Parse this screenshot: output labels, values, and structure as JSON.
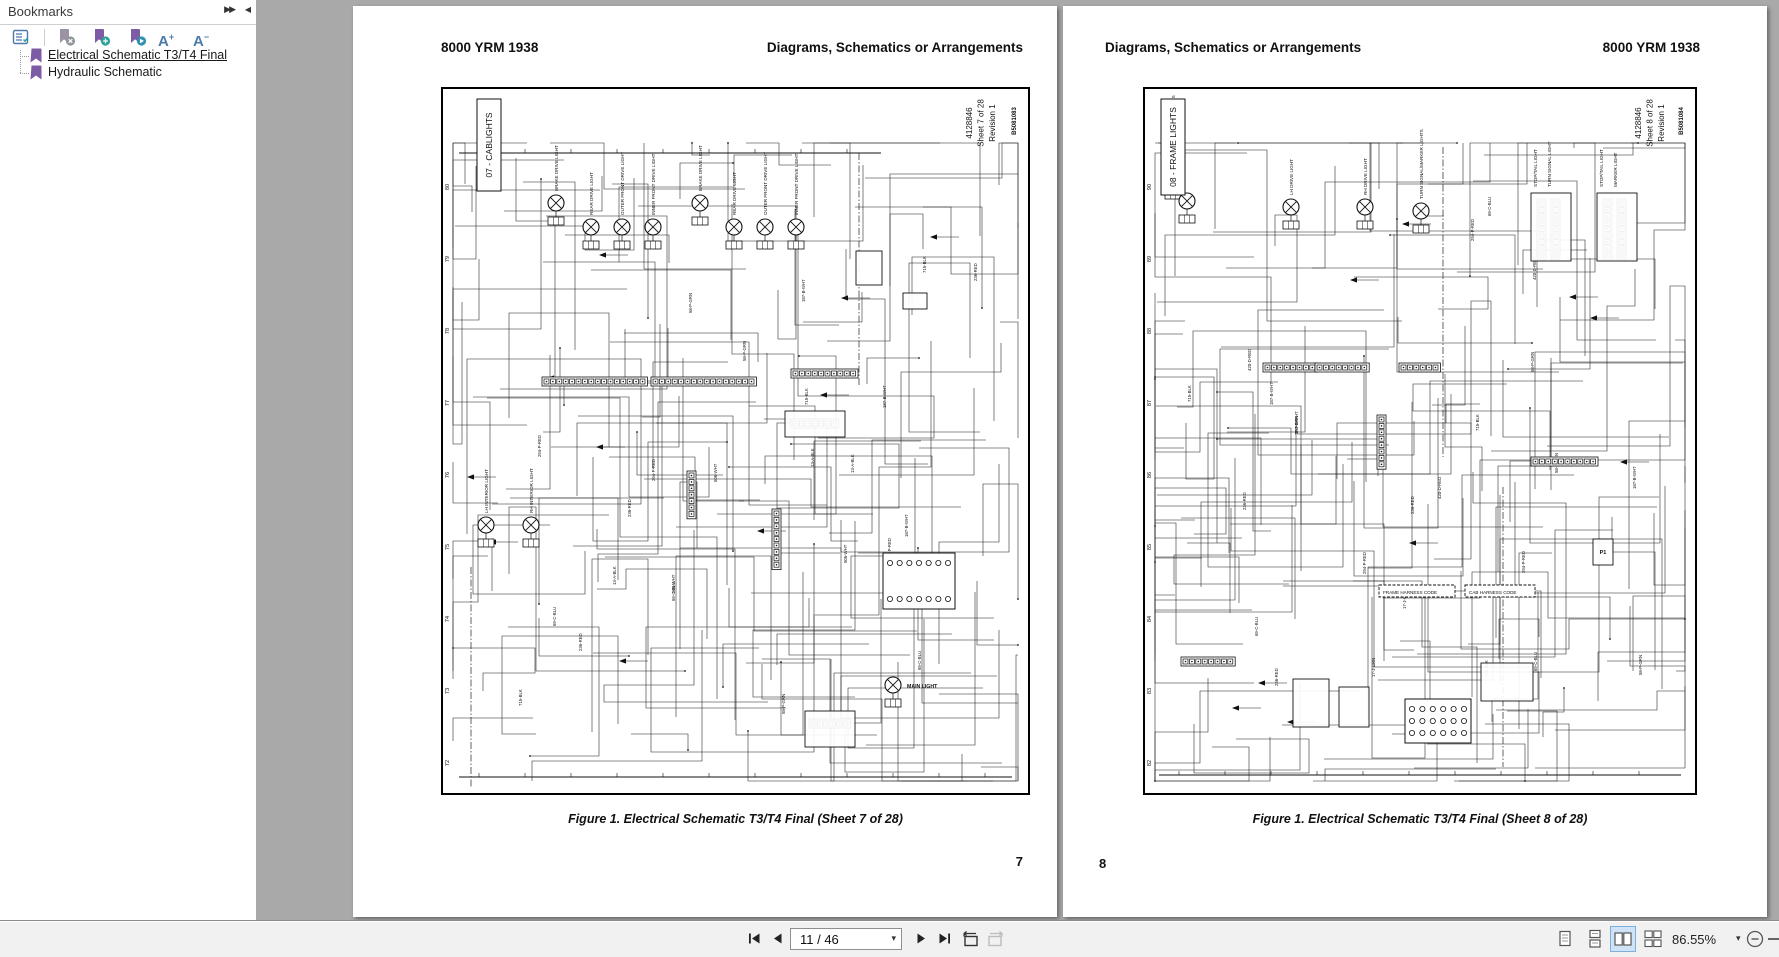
{
  "colors": {
    "c_canvas": "#a9a9a9",
    "c_purple": "#7e5ca5",
    "c_teal": "#2aa198",
    "c_blue": "#4d7ba8",
    "c_select": "#cfe3f7"
  },
  "panel": {
    "title": "Bookmarks",
    "items": [
      {
        "label": "Electrical Schematic T3/T4 Final",
        "selected": true
      },
      {
        "label": "Hydraulic Schematic",
        "selected": false
      }
    ]
  },
  "toolbar": {
    "page_field": "11 / 46",
    "zoom_value": "86.55%"
  },
  "pages": [
    {
      "header_left": "8000 YRM 1938",
      "header_right": "Diagrams, Schematics or Arrangements",
      "caption": "Figure 1. Electrical Schematic T3/T4 Final (Sheet 7 of 28)",
      "page_number": "7",
      "schematic": {
        "section_label": "07 - CABLIGHTS",
        "sheet_info": [
          "4128846",
          "Sheet 7 of 28",
          "Revision 1"
        ],
        "doc_code": "B5081083",
        "row_numbers": [
          "80",
          "79",
          "78",
          "77",
          "76",
          "75",
          "74",
          "73",
          "72"
        ],
        "row_start": 100,
        "row_step": 72,
        "label_box": {
          "x": 36,
          "y": 12,
          "w": 24,
          "h": 92
        },
        "info_x": 531,
        "code_x": 575,
        "seed": 7,
        "wire_count": 130,
        "wire_tags": [
          "236-RED",
          "715-BLK",
          "506-WHT",
          "58-P-GRN",
          "13-A-BLK",
          "294-P-RED",
          "187-B-WHT",
          "69-C-BLU"
        ],
        "buses": [
          {
            "x1": 18,
            "y1": 66,
            "x2": 440,
            "y2": 66
          },
          {
            "x1": 18,
            "y1": 690,
            "x2": 571,
            "y2": 690
          }
        ],
        "dashlines": [
          {
            "x": 418,
            "y1": 66,
            "y2": 300
          },
          {
            "x": 30,
            "y1": 480,
            "y2": 700
          }
        ],
        "lamps": [
          {
            "x": 115,
            "y": 116,
            "label": "BRAKE DRIVE LIGHT"
          },
          {
            "x": 150,
            "y": 140,
            "label": "REAR DRIVE LIGHT"
          },
          {
            "x": 181,
            "y": 140,
            "label": "OUTER FRONT DRIVE LIGHT"
          },
          {
            "x": 212,
            "y": 140,
            "label": "INNER FRONT DRIVE LIGHT"
          },
          {
            "x": 259,
            "y": 116,
            "label": "BRAKE DRIVE LIGHT"
          },
          {
            "x": 293,
            "y": 140,
            "label": "REAR DRIVE LIGHT"
          },
          {
            "x": 324,
            "y": 140,
            "label": "OUTER FRONT DRIVE LIGHT"
          },
          {
            "x": 355,
            "y": 140,
            "label": "INNER FRONT DRIVE LIGHT"
          },
          {
            "x": 45,
            "y": 438,
            "label": "LH INTERIOR LIGHT"
          },
          {
            "x": 90,
            "y": 438,
            "label": "RH INTERIOR LIGHT"
          },
          {
            "x": 452,
            "y": 598,
            "label": ""
          }
        ],
        "strips": [
          {
            "x": 103,
            "y": 292,
            "n": 16
          },
          {
            "x": 212,
            "y": 292,
            "n": 16
          },
          {
            "x": 352,
            "y": 284,
            "n": 10
          },
          {
            "x": 352,
            "y": 334,
            "n": 7
          },
          {
            "x": 370,
            "y": 634,
            "n": 6
          },
          {
            "x": 333,
            "y": 424,
            "n": 9,
            "v": 1
          },
          {
            "x": 248,
            "y": 386,
            "n": 7,
            "v": 1
          }
        ],
        "boxes": [
          {
            "x": 344,
            "y": 324,
            "w": 60,
            "h": 26
          },
          {
            "x": 415,
            "y": 164,
            "w": 26,
            "h": 34
          },
          {
            "x": 462,
            "y": 206,
            "w": 24,
            "h": 16
          },
          {
            "x": 364,
            "y": 624,
            "w": 50,
            "h": 36
          }
        ],
        "relays": [
          {
            "x": 442,
            "y": 466,
            "w": 72,
            "h": 56,
            "rows": 2,
            "cols": 7
          }
        ],
        "htexts": [
          {
            "x": 466,
            "y": 601,
            "t": "MAIN LIGHT",
            "b": 1
          }
        ],
        "vtexts": []
      }
    },
    {
      "header_left": "Diagrams, Schematics or Arrangements",
      "header_right": "8000 YRM 1938",
      "caption": "Figure 1. Electrical Schematic T3/T4 Final (Sheet 8 of 28)",
      "page_number": "8",
      "schematic": {
        "section_label": "08 - FRAME LIGHTS",
        "sheet_info": [
          "4128846",
          "Sheet 8 of 28",
          "Revision 1"
        ],
        "doc_code": "B5081084",
        "row_numbers": [
          "90",
          "89",
          "88",
          "87",
          "86",
          "85",
          "84",
          "83",
          "82"
        ],
        "row_start": 100,
        "row_step": 72,
        "label_box": {
          "x": 18,
          "y": 12,
          "w": 24,
          "h": 96
        },
        "info_x": 498,
        "code_x": 540,
        "seed": 8,
        "wire_count": 130,
        "wire_tags": [
          "294-P-RED",
          "187-B-WHT",
          "69-C-BLU",
          "17-J-GRN",
          "420-D-RED",
          "715-BLK",
          "58-P-GRN",
          "236-RED"
        ],
        "buses": [
          {
            "x1": 16,
            "y1": 688,
            "x2": 538,
            "y2": 688
          }
        ],
        "dashlines": [
          {
            "x": 300,
            "y1": 60,
            "y2": 370
          },
          {
            "x": 360,
            "y1": 400,
            "y2": 680
          }
        ],
        "lamps": [
          {
            "x": 30,
            "y": 90,
            "label": "TURN SIGNAL/MARKER LIGHTS"
          },
          {
            "x": 44,
            "y": 114,
            "label": ""
          },
          {
            "x": 148,
            "y": 120,
            "label": "LH DRIVE LIGHT"
          },
          {
            "x": 222,
            "y": 120,
            "label": "RH DRIVE LIGHT"
          },
          {
            "x": 278,
            "y": 124,
            "label": "TURN SIGNAL/MARKER LIGHTS"
          }
        ],
        "strips": [
          {
            "x": 122,
            "y": 278,
            "n": 8
          },
          {
            "x": 174,
            "y": 278,
            "n": 8
          },
          {
            "x": 258,
            "y": 278,
            "n": 6
          },
          {
            "x": 390,
            "y": 372,
            "n": 10
          },
          {
            "x": 40,
            "y": 572,
            "n": 8
          },
          {
            "x": 396,
            "y": 114,
            "n": 9,
            "v": 1
          },
          {
            "x": 410,
            "y": 114,
            "n": 9,
            "v": 1
          },
          {
            "x": 462,
            "y": 114,
            "n": 9,
            "v": 1
          },
          {
            "x": 476,
            "y": 114,
            "n": 9,
            "v": 1
          },
          {
            "x": 236,
            "y": 330,
            "n": 8,
            "v": 1
          }
        ],
        "boxes": [
          {
            "x": 388,
            "y": 106,
            "w": 40,
            "h": 68
          },
          {
            "x": 454,
            "y": 106,
            "w": 40,
            "h": 68
          },
          {
            "x": 450,
            "y": 452,
            "w": 20,
            "h": 26,
            "label": "P1"
          },
          {
            "x": 150,
            "y": 592,
            "w": 36,
            "h": 48
          },
          {
            "x": 196,
            "y": 600,
            "w": 30,
            "h": 40
          },
          {
            "x": 338,
            "y": 576,
            "w": 52,
            "h": 38
          },
          {
            "x": 236,
            "y": 498,
            "w": 76,
            "h": 12,
            "dash": 1
          },
          {
            "x": 322,
            "y": 498,
            "w": 70,
            "h": 12,
            "dash": 1
          }
        ],
        "relays": [
          {
            "x": 262,
            "y": 612,
            "w": 66,
            "h": 44,
            "rows": 3,
            "cols": 6
          }
        ],
        "htexts": [
          {
            "x": 240,
            "y": 507,
            "t": "FRAME HARNESS CODE"
          },
          {
            "x": 326,
            "y": 507,
            "t": "CAB HARNESS CODE"
          }
        ],
        "vtexts": [
          {
            "x": 394,
            "y": 100,
            "t": "STOP/TAIL LIGHT"
          },
          {
            "x": 408,
            "y": 100,
            "t": "TURN SIGNAL LIGHT"
          },
          {
            "x": 460,
            "y": 100,
            "t": "STOP/TAIL LIGHT"
          },
          {
            "x": 474,
            "y": 100,
            "t": "MARKER LIGHT"
          }
        ]
      }
    }
  ]
}
